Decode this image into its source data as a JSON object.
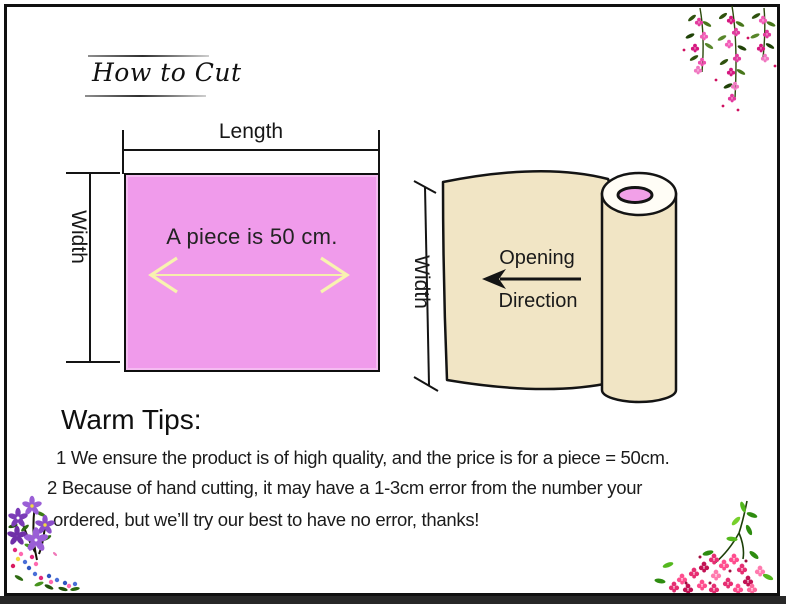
{
  "page": {
    "title": "How to Cut"
  },
  "piece_diagram": {
    "length_label": "Length",
    "width_label": "Width",
    "piece_text": "A piece is 50 cm."
  },
  "roll_diagram": {
    "width_label": "Width",
    "opening_label": "Opening",
    "direction_label": "Direction"
  },
  "warm_tips": {
    "heading": "Warm Tips:",
    "lines": [
      "1 We ensure the product is of high quality, and the price is for a piece = 50cm.",
      "2 Because of hand cutting, it may have a 1-3cm error from the number your",
      "ordered, but we’ll try our best to have no error, thanks!"
    ]
  },
  "decorations": {
    "top_right": "hanging-pink-flowers",
    "bottom_left": "purple-flower-bouquet",
    "bottom_right": "pink-flower-sprig"
  },
  "colors": {
    "piece_fill": "#F09BEB",
    "arrow_yellow": "#F8F3B0",
    "roll_fill": "#F1E5C5",
    "core_pink": "#F2A0E8",
    "ink": "#141414",
    "bottom_bar": "#282828"
  }
}
